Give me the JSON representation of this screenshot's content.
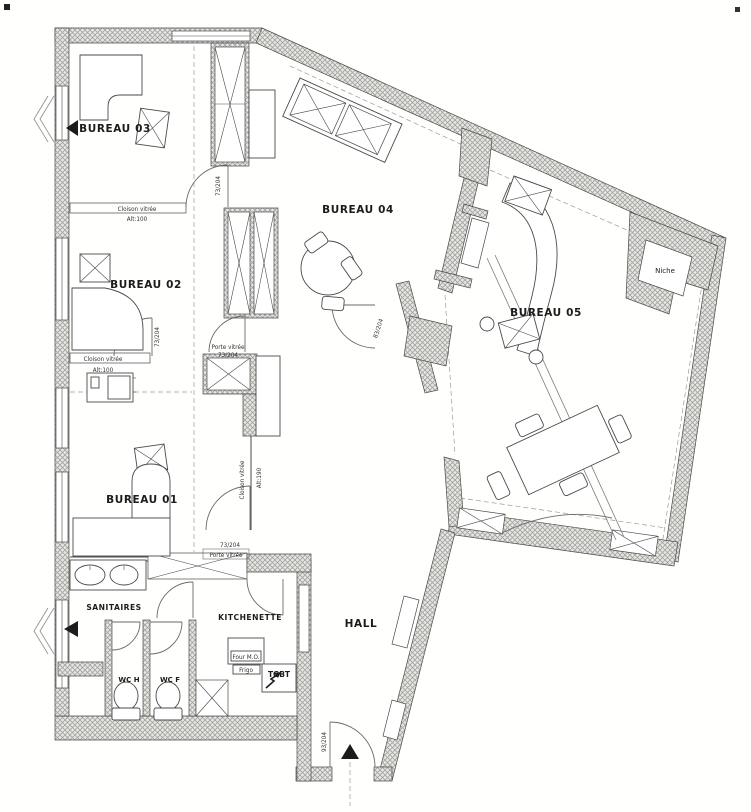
{
  "rooms": {
    "bureau01": "BUREAU 01",
    "bureau02": "BUREAU 02",
    "bureau03": "BUREAU 03",
    "bureau04": "BUREAU 04",
    "bureau05": "BUREAU 05",
    "sanitaires": "SANITAIRES",
    "kitchenette": "KITCHENETTE",
    "hall": "HALL",
    "wc_h": "WC H",
    "wc_f": "WC F",
    "niche": "Niche"
  },
  "equipment": {
    "four_mo": "Four M.O.",
    "frigo": "Frigo",
    "tgbt": "TGBT"
  },
  "annotations": {
    "cloison_vitree": "Cloison vitrée",
    "alt_100": "Alt:100",
    "alt_190": "Alt:190",
    "porte_vitree": "Porte vitrée",
    "door_73_204": "73/204",
    "door_83_204": "83/204",
    "door_93_204": "93/204"
  },
  "colors": {
    "paper": "#fffffe",
    "wall_hatch_line": "#a2a29e",
    "wall_hatch_bg": "#e7e7e4",
    "ink": "#1c1c1c"
  }
}
